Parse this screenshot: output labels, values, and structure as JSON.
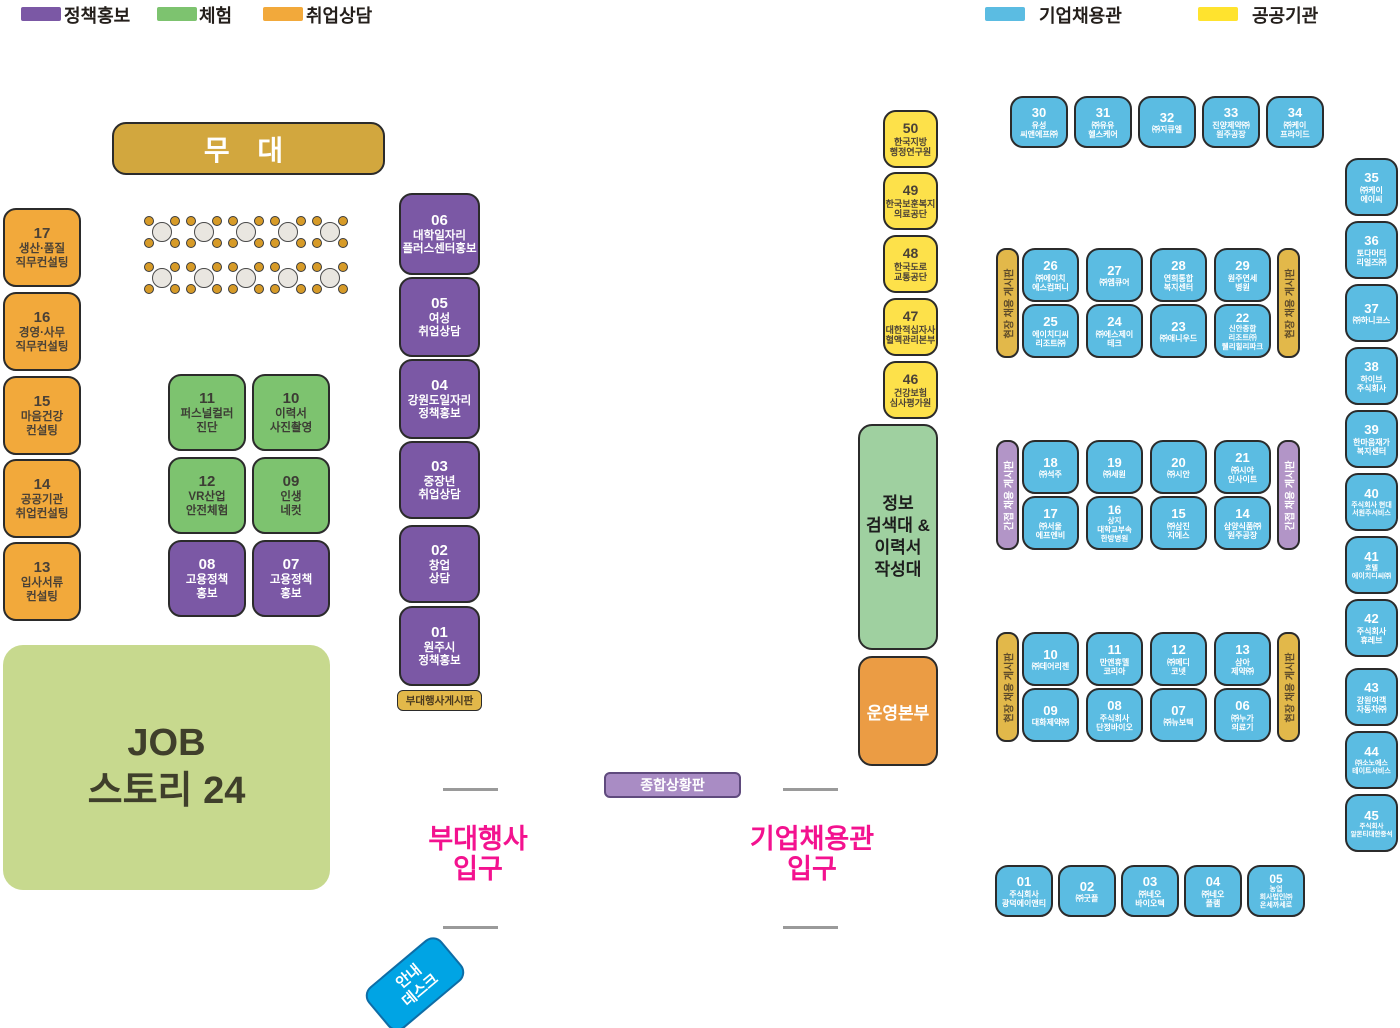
{
  "legend": {
    "left": [
      {
        "label": "정책홍보",
        "color": "#7B58A5"
      },
      {
        "label": "체험",
        "color": "#7DC36F"
      },
      {
        "label": "취업상담",
        "color": "#F2A93B"
      }
    ],
    "right": [
      {
        "label": "기업채용관",
        "color": "#5BBCE2"
      },
      {
        "label": "공공기관",
        "color": "#FFE32E"
      }
    ]
  },
  "stage": {
    "label": "무 대"
  },
  "zones": {
    "left_consult": [
      {
        "num": "17",
        "name": "생산·품질\n직무컨설팅"
      },
      {
        "num": "16",
        "name": "경영·사무\n직무컨설팅"
      },
      {
        "num": "15",
        "name": "마음건강\n컨설팅"
      },
      {
        "num": "14",
        "name": "공공기관\n취업컨설팅"
      },
      {
        "num": "13",
        "name": "입사서류\n컨설팅"
      }
    ],
    "experience": [
      {
        "num": "11",
        "name": "퍼스널컬러\n진단"
      },
      {
        "num": "10",
        "name": "이력서\n사진촬영"
      },
      {
        "num": "12",
        "name": "VR산업\n안전체험"
      },
      {
        "num": "09",
        "name": "인생\n네컷"
      }
    ],
    "policy_pair": [
      {
        "num": "08",
        "name": "고용정책\n홍보"
      },
      {
        "num": "07",
        "name": "고용정책\n홍보"
      }
    ],
    "sub_events": [
      {
        "num": "06",
        "name": "대학일자리\n플러스센터홍보"
      },
      {
        "num": "05",
        "name": "여성\n취업상담"
      },
      {
        "num": "04",
        "name": "강원도일자리\n정책홍보"
      },
      {
        "num": "03",
        "name": "중장년\n취업상담"
      },
      {
        "num": "02",
        "name": "창업\n상담"
      },
      {
        "num": "01",
        "name": "원주시\n정책홍보"
      }
    ],
    "board_label": "부대행사게시판",
    "public_orgs": [
      {
        "num": "50",
        "name": "한국지방\n행정연구원"
      },
      {
        "num": "49",
        "name": "한국보훈복지\n의료공단"
      },
      {
        "num": "48",
        "name": "한국도로\n교통공단"
      },
      {
        "num": "47",
        "name": "대한적십자사\n혈액관리본부"
      },
      {
        "num": "46",
        "name": "건강보험\n심사평가원"
      }
    ],
    "info_search": "정보\n검색대 &\n이력서\n작성대",
    "ops_center": "운영본부",
    "job_story": "JOB\n스토리 24"
  },
  "company": {
    "top": [
      {
        "num": "30",
        "name": "유성\n씨앤에프㈜"
      },
      {
        "num": "31",
        "name": "㈜유유\n헬스케어"
      },
      {
        "num": "32",
        "name": "㈜지큐엘"
      },
      {
        "num": "33",
        "name": "진양제약㈜\n원주공장"
      },
      {
        "num": "34",
        "name": "㈜케이\n프라이드"
      }
    ],
    "mid1": {
      "label": "현장 채용 게시판",
      "row1": [
        {
          "num": "26",
          "name": "㈜에이치\n에스컴퍼니"
        },
        {
          "num": "27",
          "name": "㈜엠큐어"
        },
        {
          "num": "28",
          "name": "연희통합\n복지센터"
        },
        {
          "num": "29",
          "name": "원주연세\n병원"
        }
      ],
      "row2": [
        {
          "num": "25",
          "name": "에이치디씨\n리조트㈜"
        },
        {
          "num": "24",
          "name": "㈜에스제이\n테크"
        },
        {
          "num": "23",
          "name": "㈜애니우드"
        },
        {
          "num": "22",
          "name": "신안종합\n리조트㈜\n웰리힐리파크"
        }
      ]
    },
    "mid2": {
      "label": "간접 채용 게시판",
      "row1": [
        {
          "num": "18",
          "name": "㈜석주"
        },
        {
          "num": "19",
          "name": "㈜세원"
        },
        {
          "num": "20",
          "name": "㈜시안"
        },
        {
          "num": "21",
          "name": "㈜시야\n인사이트"
        }
      ],
      "row2": [
        {
          "num": "17",
          "name": "㈜서울\n에프엔비"
        },
        {
          "num": "16",
          "name": "상지\n대학교부속\n한방병원"
        },
        {
          "num": "15",
          "name": "㈜삼진\n지에스"
        },
        {
          "num": "14",
          "name": "삼양식품㈜\n원주공장"
        }
      ]
    },
    "mid3": {
      "label": "현장 채용 게시판",
      "row1": [
        {
          "num": "10",
          "name": "㈜데어리젠"
        },
        {
          "num": "11",
          "name": "만앤휴멜\n코리아"
        },
        {
          "num": "12",
          "name": "㈜메디\n코넷"
        },
        {
          "num": "13",
          "name": "삼아\n제약㈜"
        }
      ],
      "row2": [
        {
          "num": "09",
          "name": "대화제약㈜"
        },
        {
          "num": "08",
          "name": "주식회사\n단정바이오"
        },
        {
          "num": "07",
          "name": "㈜뉴보텍"
        },
        {
          "num": "06",
          "name": "㈜누가\n의료기"
        }
      ]
    },
    "right_col": [
      {
        "num": "35",
        "name": "㈜케이\n에이씨"
      },
      {
        "num": "36",
        "name": "토다머티\n리얼즈㈜"
      },
      {
        "num": "37",
        "name": "㈜하니코스"
      },
      {
        "num": "38",
        "name": "하이브\n주식회사"
      },
      {
        "num": "39",
        "name": "한마음재가\n복지센터"
      },
      {
        "num": "40",
        "name": "주식회사 현대\n서원주서비스"
      },
      {
        "num": "41",
        "name": "호텔\n에이치디씨㈜"
      },
      {
        "num": "42",
        "name": "주식회사\n휴레브"
      },
      {
        "num": "43",
        "name": "강원여객\n자동차㈜"
      },
      {
        "num": "44",
        "name": "㈜소노에스\n테이트서비스"
      },
      {
        "num": "45",
        "name": "주식회사\n알몬티대한중석"
      }
    ],
    "bottom": [
      {
        "num": "01",
        "name": "주식회사\n광덕에이앤티"
      },
      {
        "num": "02",
        "name": "㈜굿플"
      },
      {
        "num": "03",
        "name": "㈜네오\n바이오텍"
      },
      {
        "num": "04",
        "name": "㈜네오\n플램"
      },
      {
        "num": "05",
        "name": "농업\n회사법인㈜\n온세까세로"
      }
    ]
  },
  "signs": {
    "status_board": "종합상황판",
    "entrance_left": "부대행사\n입구",
    "entrance_right": "기업채용관\n입구",
    "info_desk": "안내\n데스크"
  }
}
